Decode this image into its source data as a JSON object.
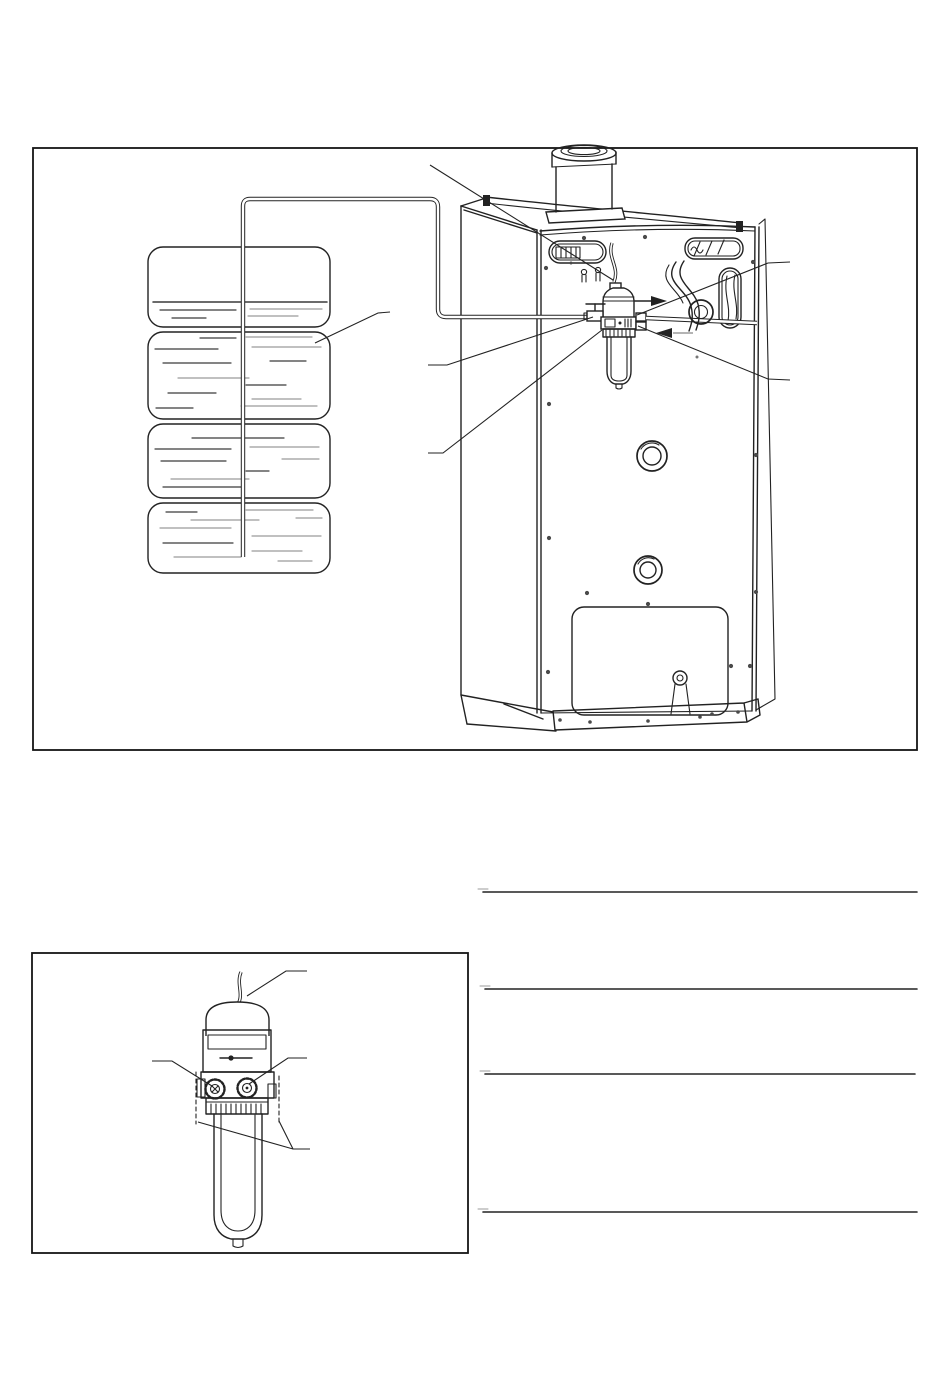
{
  "page": {
    "width": 950,
    "height": 1387,
    "background": "#ffffff",
    "ink": "#222222",
    "gray": "#9b9b9b"
  },
  "figure1": {
    "name": "oil-tank-to-boiler-fuel-line-installation-diagram",
    "frame": {
      "x": 33,
      "y": 148,
      "width": 884,
      "height": 602
    },
    "tank": {
      "sections": 4,
      "level_dashes": [
        [
          153,
          302,
          327,
          302,
          1.5,
          "#3a3a3a"
        ],
        [
          160,
          310,
          236,
          310,
          1.2,
          "#3a3a3a"
        ],
        [
          250,
          309,
          322,
          309,
          1.2,
          "#9b9b9b"
        ],
        [
          172,
          318,
          206,
          318,
          1.2,
          "#3a3a3a"
        ],
        [
          248,
          316,
          298,
          316,
          1.2,
          "#9b9b9b"
        ],
        [
          200,
          338,
          236,
          338,
          1.2,
          "#3a3a3a"
        ],
        [
          246,
          337,
          312,
          337,
          1.2,
          "#9b9b9b"
        ],
        [
          155,
          349,
          218,
          349,
          1.2,
          "#3a3a3a"
        ],
        [
          252,
          347,
          321,
          347,
          1.2,
          "#9b9b9b"
        ],
        [
          163,
          363,
          231,
          363,
          1.2,
          "#3a3a3a"
        ],
        [
          270,
          361,
          306,
          361,
          1.2,
          "#3a3a3a"
        ],
        [
          178,
          378,
          249,
          378,
          1.2,
          "#9b9b9b"
        ],
        [
          246,
          385,
          286,
          385,
          1.2,
          "#3a3a3a"
        ],
        [
          168,
          393,
          216,
          393,
          1.2,
          "#3a3a3a"
        ],
        [
          252,
          399,
          301,
          399,
          1.2,
          "#9b9b9b"
        ],
        [
          156,
          408,
          193,
          408,
          1.2,
          "#3a3a3a"
        ],
        [
          241,
          406,
          317,
          406,
          1.2,
          "#9b9b9b"
        ],
        [
          192,
          438,
          284,
          438,
          1.2,
          "#3a3a3a"
        ],
        [
          250,
          447,
          319,
          447,
          1.2,
          "#9b9b9b"
        ],
        [
          155,
          449,
          231,
          449,
          1.2,
          "#3a3a3a"
        ],
        [
          161,
          461,
          226,
          461,
          1.2,
          "#3a3a3a"
        ],
        [
          282,
          459,
          319,
          459,
          1.2,
          "#9b9b9b"
        ],
        [
          246,
          471,
          269,
          471,
          1.2,
          "#3a3a3a"
        ],
        [
          171,
          479,
          249,
          479,
          1.2,
          "#9b9b9b"
        ],
        [
          163,
          487,
          241,
          487,
          1.2,
          "#3a3a3a"
        ],
        [
          166,
          512,
          197,
          512,
          1.2,
          "#3a3a3a"
        ],
        [
          246,
          510,
          313,
          510,
          1.2,
          "#9b9b9b"
        ],
        [
          191,
          520,
          259,
          520,
          1.2,
          "#9b9b9b"
        ],
        [
          296,
          518,
          322,
          518,
          1.2,
          "#9b9b9b"
        ],
        [
          160,
          528,
          231,
          528,
          1.2,
          "#9b9b9b"
        ],
        [
          252,
          536,
          321,
          536,
          1.2,
          "#9b9b9b"
        ],
        [
          163,
          543,
          233,
          543,
          1.2,
          "#3a3a3a"
        ],
        [
          252,
          551,
          302,
          551,
          1.2,
          "#9b9b9b"
        ],
        [
          174,
          557,
          241,
          557,
          1.2,
          "#9b9b9b"
        ],
        [
          278,
          561,
          312,
          561,
          1.2,
          "#9b9b9b"
        ]
      ]
    },
    "boiler": {
      "screws": [
        [
          546,
          268
        ],
        [
          584,
          238
        ],
        [
          645,
          237
        ],
        [
          571,
          263,
          1.5
        ],
        [
          549,
          404
        ],
        [
          549,
          538
        ],
        [
          548,
          672
        ],
        [
          587,
          593
        ],
        [
          648,
          604
        ],
        [
          753,
          262
        ],
        [
          756,
          455
        ],
        [
          756,
          592
        ],
        [
          731,
          666
        ],
        [
          750,
          666
        ],
        [
          560,
          720,
          1.8
        ],
        [
          590,
          722,
          1.8
        ],
        [
          648,
          721,
          1.8
        ],
        [
          700,
          717,
          1.8
        ],
        [
          712,
          714,
          1.8
        ],
        [
          738,
          712,
          1.8
        ],
        [
          697,
          357,
          1.5,
          "#777777"
        ]
      ]
    },
    "filter": {
      "collar_ticks": [
        [
          606,
          330,
          606,
          336,
          1
        ],
        [
          610,
          330,
          610,
          336,
          1
        ],
        [
          614,
          330,
          614,
          336,
          1
        ],
        [
          618,
          330,
          618,
          336,
          1
        ],
        [
          622,
          330,
          622,
          336,
          1
        ],
        [
          626,
          330,
          626,
          336,
          1
        ],
        [
          630,
          330,
          630,
          336,
          1
        ]
      ]
    },
    "leaders": [
      {
        "name": "leader-sensor-cable",
        "points": "430,165 613,280"
      },
      {
        "name": "leader-oil-tank",
        "points": "390,312 378,313 315,343"
      },
      {
        "name": "leader-shutoff-valve",
        "points": "428,365 447,365 593,317"
      },
      {
        "name": "leader-filter-unit",
        "points": "428,453 443,453 602,330"
      },
      {
        "name": "leader-hose-connection-upper",
        "points": "790,262 768,263 637,315"
      },
      {
        "name": "leader-hose-connection-lower",
        "points": "790,380 768,379 638,326"
      }
    ]
  },
  "figure2": {
    "name": "fuel-filter-deaerator-detail-diagram",
    "frame": {
      "x": 32,
      "y": 953,
      "width": 436,
      "height": 300
    },
    "collar_teeth": [
      [
        211,
        1104,
        211,
        1114,
        1.1
      ],
      [
        216,
        1104,
        216,
        1114,
        1.1
      ],
      [
        221,
        1104,
        221,
        1114,
        1.1
      ],
      [
        226,
        1104,
        226,
        1114,
        1.1
      ],
      [
        231,
        1104,
        231,
        1114,
        1.1
      ],
      [
        236,
        1104,
        236,
        1114,
        1.1
      ],
      [
        241,
        1104,
        241,
        1114,
        1.1
      ],
      [
        246,
        1104,
        246,
        1114,
        1.1
      ],
      [
        251,
        1104,
        251,
        1114,
        1.1
      ],
      [
        256,
        1104,
        256,
        1114,
        1.1
      ],
      [
        261,
        1104,
        261,
        1114,
        1.1
      ]
    ],
    "leaders": [
      {
        "name": "leader-sensor-cable",
        "points": "307,971 286,971 247,996"
      },
      {
        "name": "leader-inlet-fitting",
        "points": "152,1061 172,1061 212,1086"
      },
      {
        "name": "leader-outlet-fitting",
        "points": "307,1058 288,1058 249,1084"
      },
      {
        "name": "leader-filter-bowl-left",
        "points": "310,1149 293,1149 198,1122"
      },
      {
        "name": "leader-filter-bowl-right",
        "points": "293,1149 279,1121"
      }
    ]
  },
  "rules": {
    "lines": [
      [
        483,
        892,
        917,
        892,
        1.6
      ],
      [
        485,
        989,
        917,
        989,
        1.6
      ],
      [
        485,
        1074,
        915,
        1074,
        1.6
      ],
      [
        483,
        1212,
        917,
        1212,
        1.6
      ]
    ],
    "ticks": [
      [
        478,
        889,
        488,
        889,
        1,
        "#9b9b9b"
      ],
      [
        480,
        986,
        490,
        986,
        1,
        "#9b9b9b"
      ],
      [
        480,
        1071,
        490,
        1071,
        1,
        "#9b9b9b"
      ],
      [
        478,
        1209,
        488,
        1209,
        1,
        "#9b9b9b"
      ]
    ]
  }
}
